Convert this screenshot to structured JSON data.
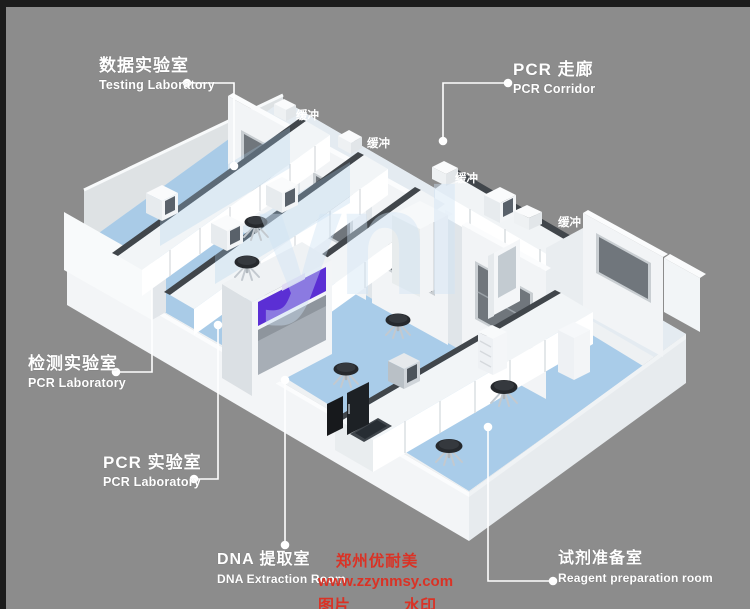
{
  "callouts": {
    "testing_lab": {
      "zh": "数据实验室",
      "en": "Testing Laboratory"
    },
    "pcr_corridor": {
      "zh": "PCR 走廊",
      "en": "PCR Corridor"
    },
    "detection_lab": {
      "zh": "检测实验室",
      "en": "PCR Laboratory"
    },
    "pcr_lab": {
      "zh": "PCR 实验室",
      "en": "PCR Laboratory"
    },
    "dna_extraction": {
      "zh": "DNA 提取室",
      "en": "DNA Extraction Room"
    },
    "reagent_prep": {
      "zh": "试剂准备室",
      "en": "Reagent preparation room"
    }
  },
  "room_tags": {
    "buffer_1": "缓冲",
    "buffer_2": "缓冲",
    "buffer_3": "缓冲",
    "buffer_4": "缓冲"
  },
  "watermarks": {
    "brand_overlay": "ynl",
    "red_line1": "郑州优耐美",
    "red_line2": "www.zzynmsy.com",
    "red_left": "图片",
    "red_right": "水印"
  },
  "colors": {
    "background": "#8c8c8c",
    "floor_blue": "#a9cbe7",
    "wall_white": "#f2f4f6",
    "counter_dark": "#41464b",
    "window_glass": "#70767c",
    "accent_purple": "#5b2fd4",
    "watermark_red": "#e12b1d",
    "label_text": "#ffffff"
  }
}
